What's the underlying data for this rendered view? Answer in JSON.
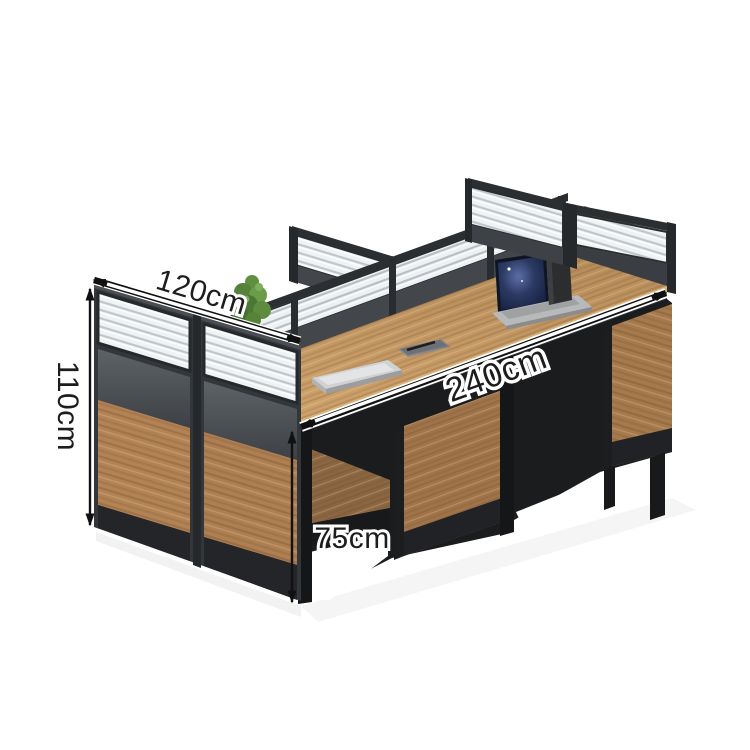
{
  "page": {
    "background": "#ffffff",
    "kind": "furniture product photo with dimension annotations"
  },
  "product": {
    "name": "4-person office workstation cluster with privacy screens",
    "features": [
      "wood laminate desktops",
      "charcoal metal frames",
      "reeded glass screen toppers",
      "modesty panels"
    ]
  },
  "dimensions": {
    "depth": "120cm",
    "height": "110cm",
    "length": "240cm",
    "desk_height": "75cm"
  },
  "annotation": {
    "text_color": "#1d1d1d",
    "halo_color": "#ffffff",
    "arrow_color": "#111111"
  },
  "colors": {
    "desk_wood": "#c89c67",
    "desk_edge": "#d9b177",
    "panel_wood": "#b28355",
    "under_panel_wood": "#a0744a",
    "frame_dark": "#33373b",
    "panel_gray_band": "#4a4f54",
    "kick_black": "#232528",
    "glass_base": "#f0f3f4",
    "glass_stripe": "#bdc5ca",
    "plant_green": "#5d8c40",
    "laptop_screen": "#1a2742",
    "laptop_silver": "#c9cbcd"
  },
  "desk_items": [
    {
      "label": "open laptop"
    },
    {
      "label": "pen cup with pens"
    },
    {
      "label": "closed laptop"
    },
    {
      "label": "notepad with pen"
    },
    {
      "label": "potted plant"
    }
  ]
}
